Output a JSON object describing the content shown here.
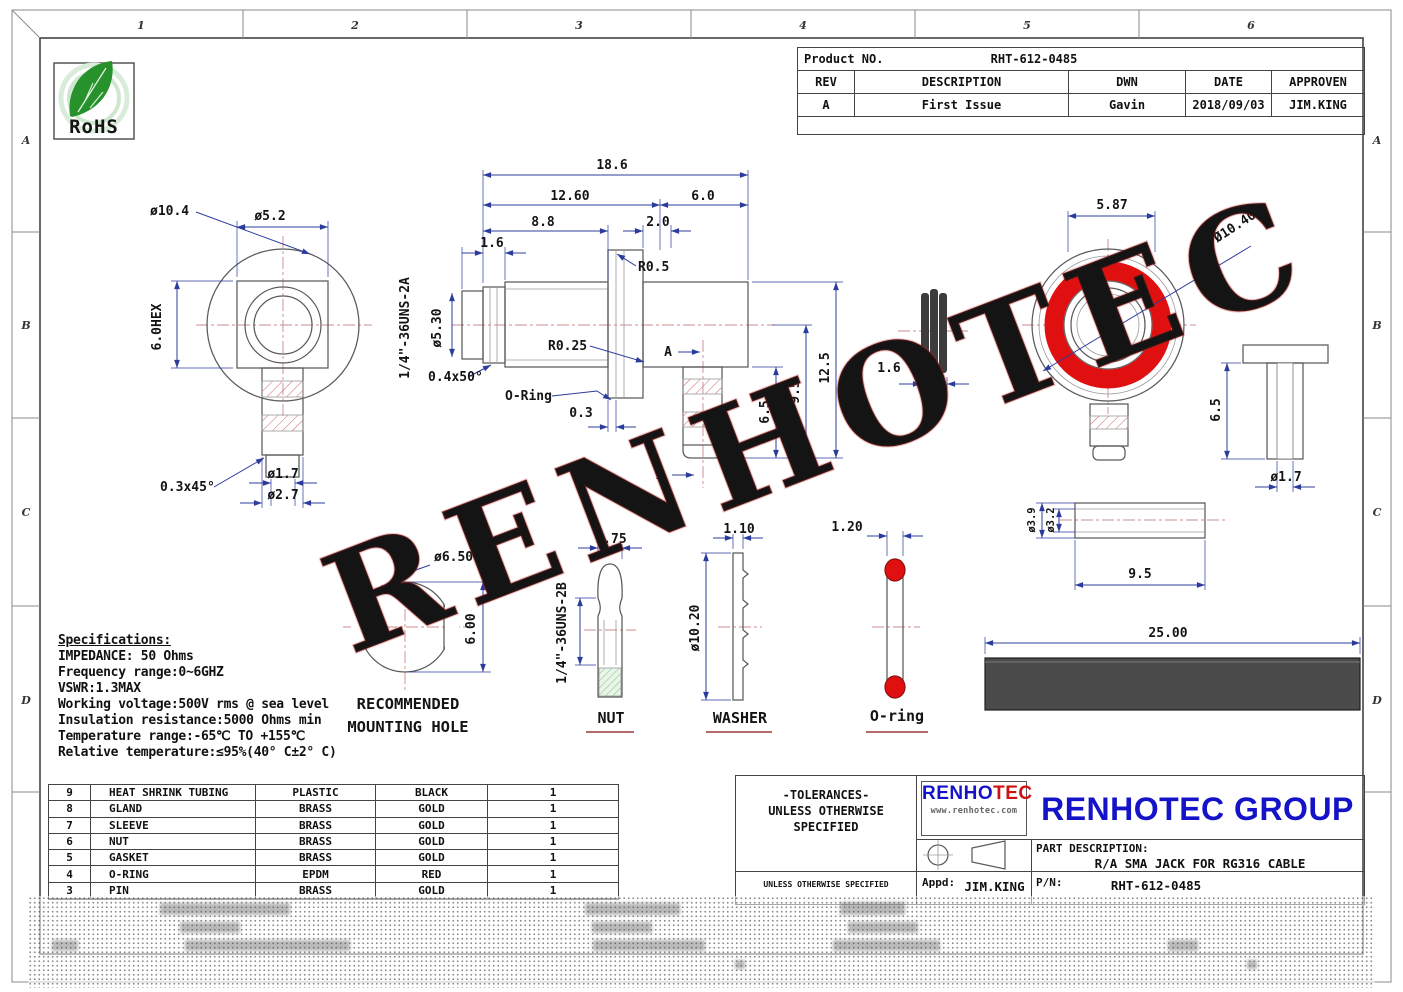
{
  "sheet": {
    "zones_top": [
      "1",
      "2",
      "3",
      "4",
      "5",
      "6"
    ],
    "zones_left": [
      "A",
      "B",
      "C",
      "D"
    ],
    "watermark": "RENHOTEC"
  },
  "rohs": {
    "text": "RoHS"
  },
  "rev_table": {
    "product_label": "Product NO.",
    "product_no": "RHT-612-0485",
    "headers": [
      "REV",
      "DESCRIPTION",
      "DWN",
      "DATE",
      "APPROVEN"
    ],
    "row": [
      "A",
      "First Issue",
      "Gavin",
      "2018/09/03",
      "JIM.KING"
    ]
  },
  "specs": {
    "title": "Specifications:",
    "lines": [
      "IMPEDANCE: 50 Ohms",
      "Frequency range:0~6GHZ",
      "VSWR:1.3MAX",
      "Working voltage:500V rms @ sea level",
      "Insulation resistance:5000 Ohms min",
      "Temperature range:-65℃ TO +155℃",
      "Relative temperature:≤95%(40° C±2° C)"
    ]
  },
  "bom": {
    "rows": [
      [
        "9",
        "HEAT SHRINK TUBING",
        "PLASTIC",
        "BLACK",
        "1"
      ],
      [
        "8",
        "GLAND",
        "BRASS",
        "GOLD",
        "1"
      ],
      [
        "7",
        "SLEEVE",
        "BRASS",
        "GOLD",
        "1"
      ],
      [
        "6",
        "NUT",
        "BRASS",
        "GOLD",
        "1"
      ],
      [
        "5",
        "GASKET",
        "BRASS",
        "GOLD",
        "1"
      ],
      [
        "4",
        "O-RING",
        "EPDM",
        "RED",
        "1"
      ],
      [
        "3",
        "PIN",
        "BRASS",
        "GOLD",
        "1"
      ]
    ]
  },
  "dims": {
    "main": {
      "d186": "18.6",
      "d1260": "12.60",
      "d60": "6.0",
      "d88": "8.8",
      "d20": "2.0",
      "d16": "1.6",
      "r05": "R0.5",
      "dia530": "ø5.30",
      "thread": "1/4\"-36UNS-2A",
      "r025": "R0.25",
      "ch0450": "0.4x50°",
      "oring": "O-Ring",
      "d03": "0.3",
      "d125": "12.5",
      "d95": "9.5",
      "d65": "6.5",
      "sec": "A"
    },
    "front": {
      "dia104": "ø10.4",
      "dia52": "ø5.2",
      "hex": "6.0HEX",
      "ch0345": "0.3x45°",
      "dia17": "ø1.7",
      "dia27": "ø2.7"
    },
    "gasket": {
      "d16": "1.6"
    },
    "ring": {
      "d587": "5.87",
      "dia1040": "Ø10.40"
    },
    "pin": {
      "d65": "6.5",
      "dia17": "ø1.7"
    },
    "mount": {
      "dia650": "ø6.50",
      "d600": "6.00",
      "cap1": "RECOMMENDED",
      "cap2": "MOUNTING HOLE"
    },
    "nut": {
      "d175": "1.75",
      "thread": "1/4\"-36UNS-2B",
      "label": "NUT"
    },
    "washer": {
      "d110": "1.10",
      "dia1020": "ø10.20",
      "label": "WASHER"
    },
    "oring": {
      "d120": "1.20",
      "label": "O-ring"
    },
    "sleeve": {
      "dia39": "ø3.9",
      "dia32": "ø3.2",
      "d95": "9.5"
    },
    "shrink": {
      "d2500": "25.00"
    }
  },
  "footer": {
    "tol1": "-TOLERANCES-",
    "tol2": "UNLESS OTHERWISE",
    "tol3": "SPECIFIED",
    "tol_small": "UNLESS OTHERWISE SPECIFIED",
    "logo_a": "RENHO",
    "logo_b": "TEC",
    "logo_url": "www.renhotec.com",
    "company": "RENHOTEC GROUP",
    "part_label": "PART DESCRIPTION:",
    "part_desc": "R/A SMA JACK FOR RG316 CABLE",
    "appd_label": "Appd:",
    "appd": "JIM.KING",
    "pn_label": "P/N:",
    "pn": "RHT-612-0485"
  },
  "colors": {
    "accent_red": "#e01010",
    "dim_blue": "#2c3c9c",
    "company_blue": "#1513c8",
    "rohs_green": "#2f9e2f"
  }
}
